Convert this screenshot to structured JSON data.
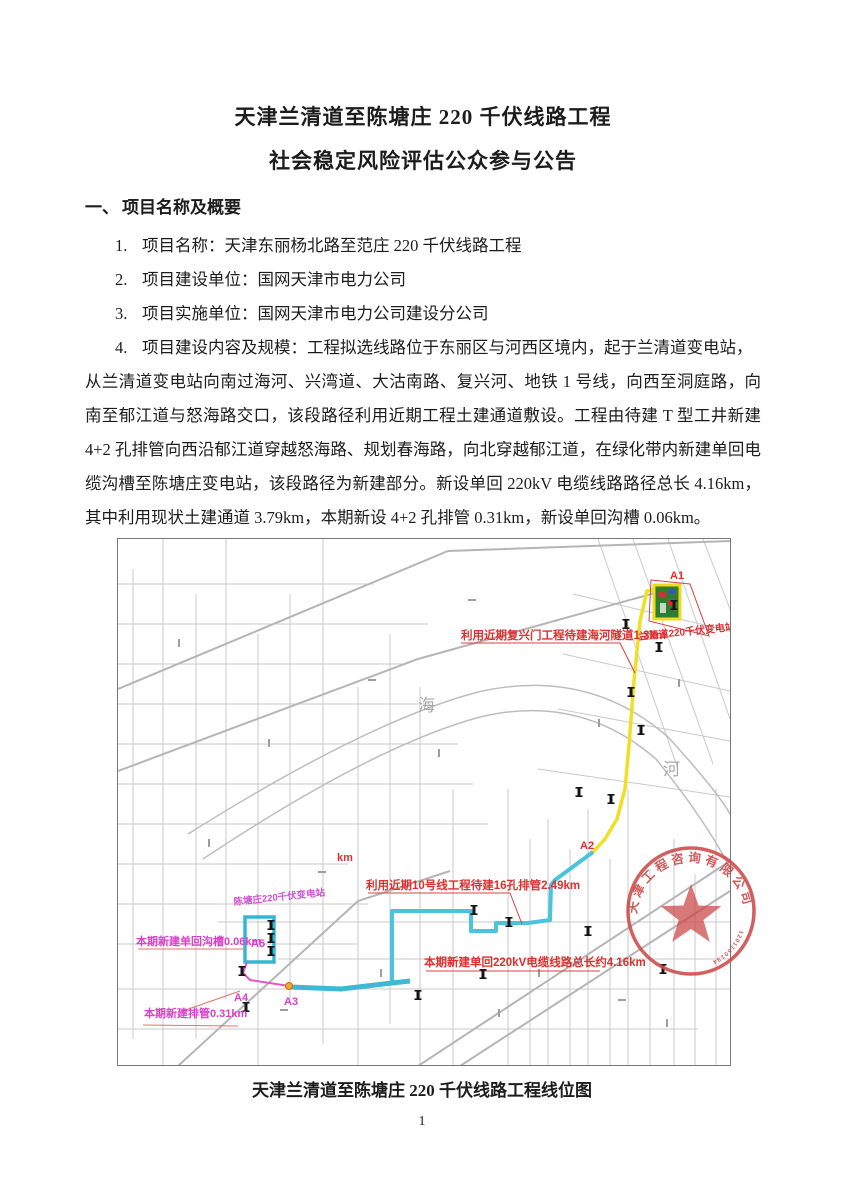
{
  "doc": {
    "title1": "天津兰清道至陈塘庄 220 千伏线路工程",
    "title2": "社会稳定风险评估公众参与公告",
    "section_num": "一、",
    "section_title": "项目名称及概要",
    "items": [
      {
        "num": "1.",
        "text": "项目名称：天津东丽杨北路至范庄 220 千伏线路工程"
      },
      {
        "num": "2.",
        "text": "项目建设单位：国网天津市电力公司"
      },
      {
        "num": "3.",
        "text": "项目实施单位：国网天津市电力公司建设分公司"
      },
      {
        "num": "4.",
        "text": "项目建设内容及规模：工程拟选线路位于东丽区与河西区境内，起于兰清道变电站，"
      }
    ],
    "paragraph": "从兰清道变电站向南过海河、兴湾道、大沽南路、复兴河、地铁 1 号线，向西至洞庭路，向南至郁江道与怒海路交口，该段路径利用近期工程土建通道敷设。工程由待建 T 型工井新建 4+2 孔排管向西沿郁江道穿越怒海路、规划春海路，向北穿越郁江道，在绿化带内新建单回电缆沟槽至陈塘庄变电站，该段路径为新建部分。新设单回 220kV 电缆线路路径总长 4.16km，其中利用现状土建通道 3.79km，本期新设 4+2 孔排管 0.31km，新设单回沟槽 0.06km。",
    "map_caption": "天津兰清道至陈塘庄 220 千伏线路工程线位图",
    "page_number": "1"
  },
  "map": {
    "labels": {
      "a1": "A1",
      "a2": "A2",
      "a3": "A3",
      "a4": "A4",
      "a5": "A5",
      "tunnel_note": "利用近期复兴门工程待建海河隧道1.3km",
      "lanqing_station": "兰清道220千伏变电站",
      "line10_note": "利用近期10号线工程待建16孔排管2.49km",
      "cable_total_note": "本期新建单回220kV电缆线路总长约4.16km",
      "trench_note": "本期新建单回沟槽0.06km",
      "duct_note": "本期新建排管0.31km",
      "chentangzhuang_station": "陈塘庄220千伏变电站",
      "scale_km": "km",
      "river_hai": "海",
      "river_he": "河"
    },
    "seal": {
      "company": "天津工程咨询有限公司",
      "number": "120116013456"
    },
    "colors": {
      "tunnel_route": "#f0df25",
      "cable_route": "#4cc3dd",
      "duct_route": "#e358c2",
      "red_note": "#d93030",
      "magenta_note": "#d93fc7",
      "seal_red": "#c94444"
    }
  }
}
